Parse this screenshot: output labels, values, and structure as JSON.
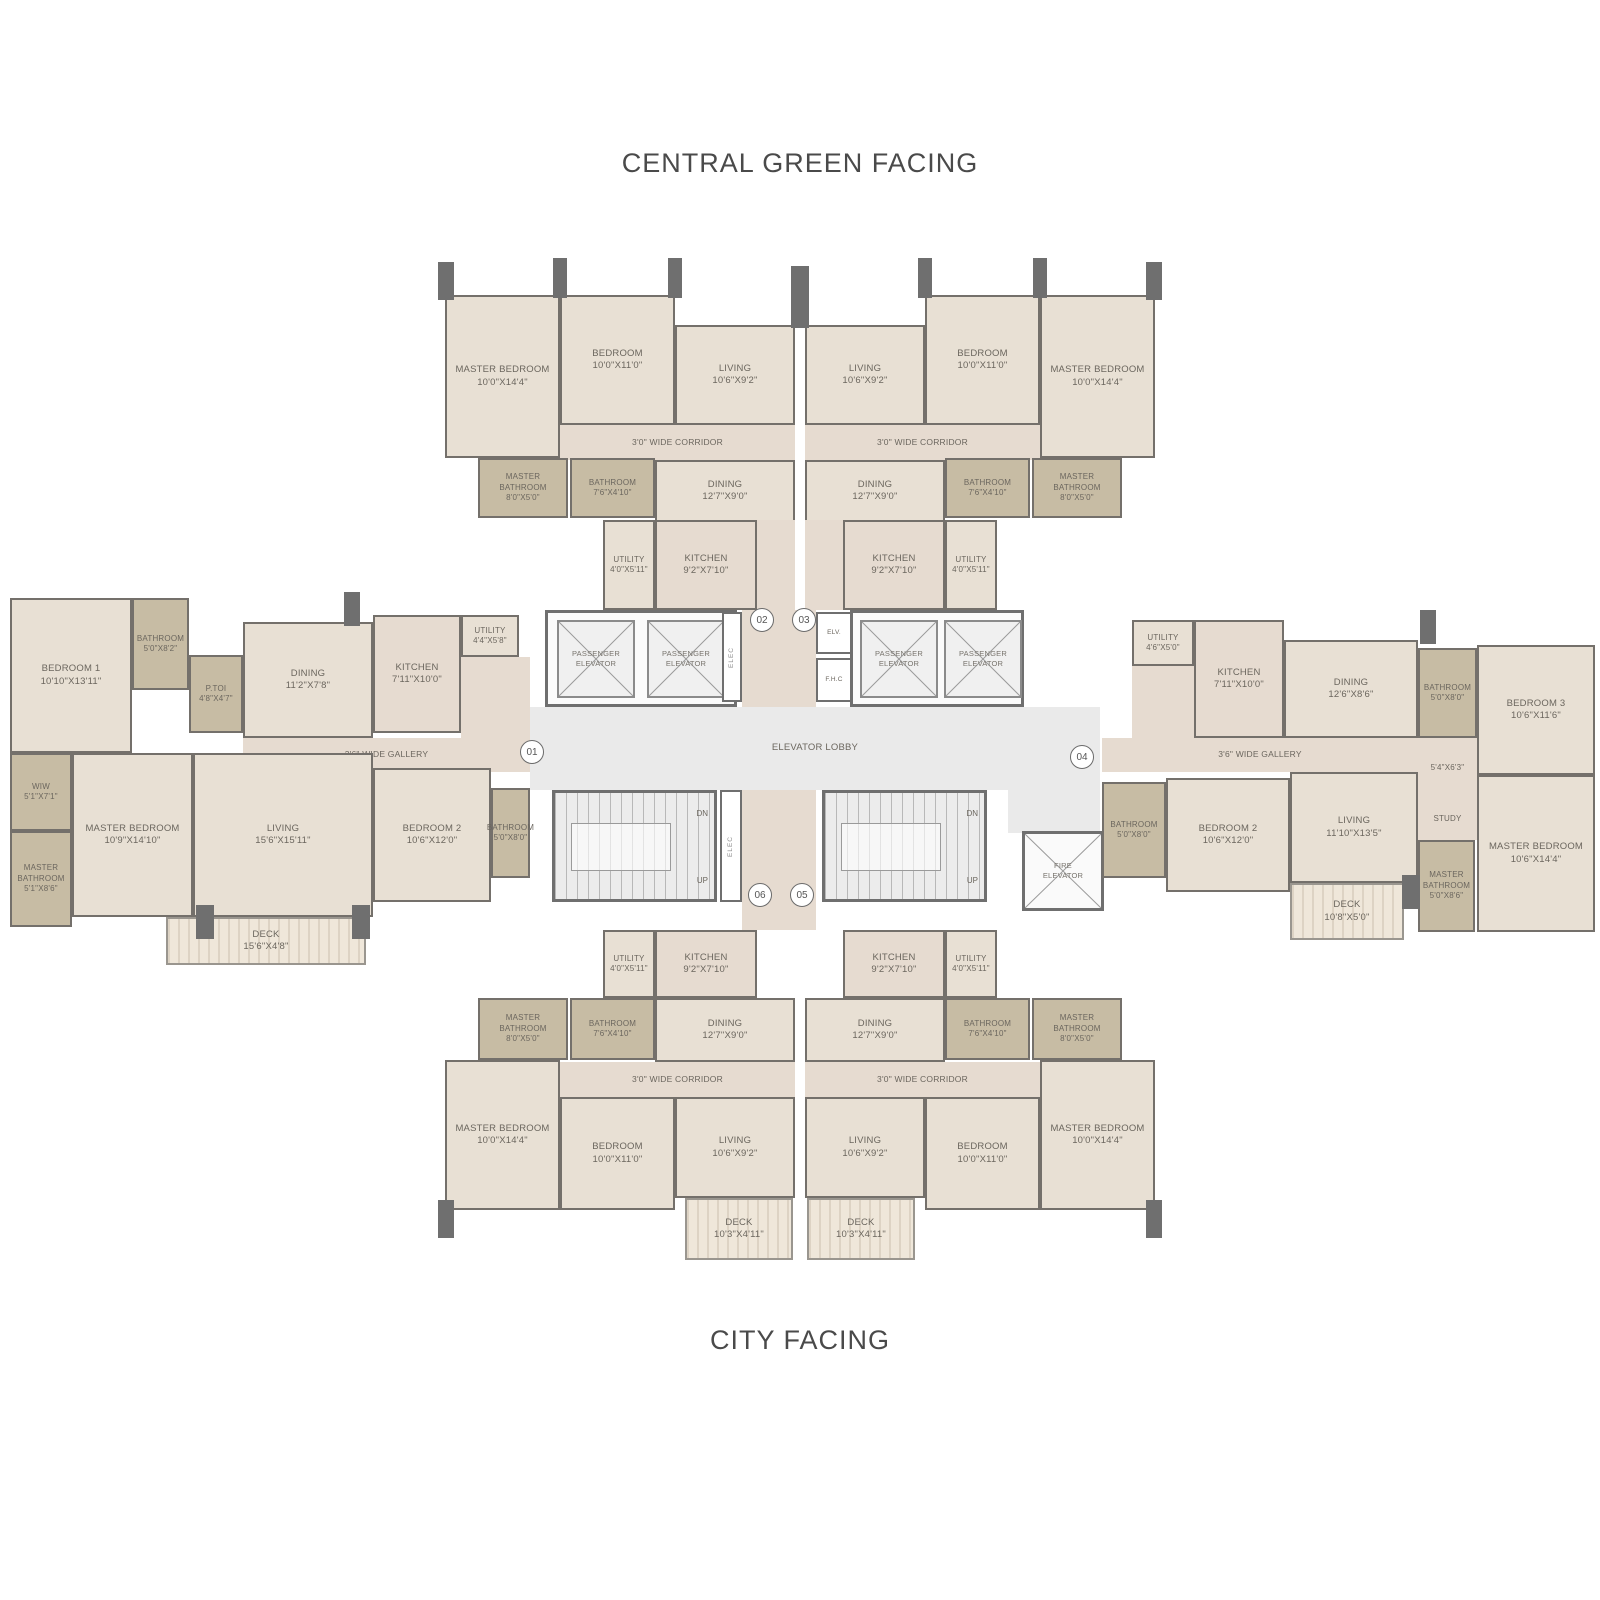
{
  "titles": {
    "top": "CENTRAL GREEN FACING",
    "bottom": "CITY FACING"
  },
  "unit_numbers": {
    "u01": "01",
    "u02": "02",
    "u03": "03",
    "u04": "04",
    "u05": "05",
    "u06": "06"
  },
  "core": {
    "passenger_elevator": "PASSENGER\nELEVATOR",
    "fire_elevator": "FIRE\nELEVATOR",
    "elevator_lobby": "ELEVATOR LOBBY",
    "elv": "ELV.",
    "fhc": "F.H.C",
    "elec": "ELEC",
    "dn": "DN",
    "up": "UP"
  },
  "ns_unit": {
    "master_bedroom": "MASTER BEDROOM\n10'0\"X14'4\"",
    "bedroom": "BEDROOM\n10'0\"X11'0\"",
    "living": "LIVING\n10'6\"X9'2\"",
    "corridor": "3'0\" WIDE CORRIDOR",
    "master_bathroom": "MASTER\nBATHROOM\n8'0\"X5'0\"",
    "bathroom": "BATHROOM\n7'6\"X4'10\"",
    "dining": "DINING\n12'7\"X9'0\"",
    "kitchen": "KITCHEN\n9'2\"X7'10\"",
    "utility": "UTILITY\n4'0\"X5'11\"",
    "deck": "DECK\n10'3\"X4'11\""
  },
  "west_unit": {
    "bedroom1": "BEDROOM 1\n10'10\"X13'11\"",
    "bathroom": "BATHROOM\n5'0\"X8'2\"",
    "ptoi": "P.TOI\n4'8\"X4'7\"",
    "dining": "DINING\n11'2\"X7'8\"",
    "kitchen": "KITCHEN\n7'11\"X10'0\"",
    "utility": "UTILITY\n4'4\"X5'8\"",
    "gallery": "3'6\" WIDE GALLERY",
    "wiw": "WIW\n5'1\"X7'1\"",
    "master_bathroom": "MASTER\nBATHROOM\n5'1\"X8'6\"",
    "master_bedroom": "MASTER BEDROOM\n10'9\"X14'10\"",
    "living": "LIVING\n15'6\"X15'11\"",
    "bedroom2": "BEDROOM 2\n10'6\"X12'0\"",
    "bathroom2": "BATHROOM\n5'0\"X8'0\"",
    "deck": "DECK\n15'6\"X4'8\""
  },
  "east_unit": {
    "utility": "UTILITY\n4'6\"X5'0\"",
    "kitchen": "KITCHEN\n7'11\"X10'0\"",
    "dining": "DINING\n12'6\"X8'6\"",
    "bathroom_top": "BATHROOM\n5'0\"X8'0\"",
    "bedroom3": "BEDROOM 3\n10'6\"X11'6\"",
    "passage": "5'4\"X6'3\"",
    "study": "STUDY",
    "gallery": "3'6\" WIDE GALLERY",
    "bathroom": "BATHROOM\n5'0\"X8'0\"",
    "bedroom2": "BEDROOM 2\n10'6\"X12'0\"",
    "living": "LIVING\n11'10\"X13'5\"",
    "master_bathroom": "MASTER\nBATHROOM\n5'0\"X8'6\"",
    "master_bedroom": "MASTER BEDROOM\n10'6\"X14'4\"",
    "deck": "DECK\n10'8\"X5'0\""
  },
  "colors": {
    "wall": "#74706b",
    "room_fill": "#e8e0d4",
    "bath_fill": "#c7bca4",
    "corridor_fill": "#e6dbd0",
    "core_fill": "#eaeaea"
  }
}
